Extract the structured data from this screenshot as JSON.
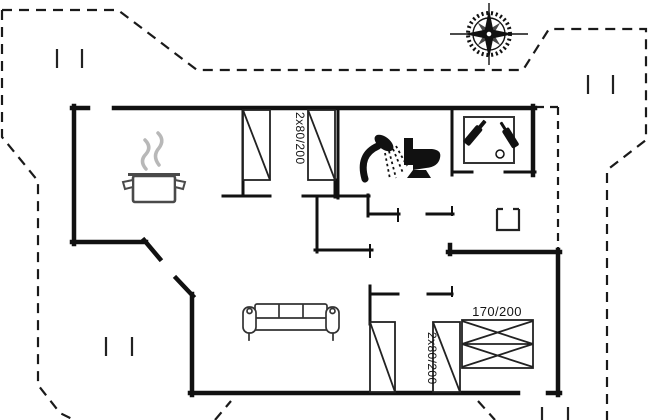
{
  "drawing": {
    "kind": "holiday-house floor plan",
    "labels": {
      "bedroom_top_beds": "2x80/200",
      "bedroom_bottom_beds": "2x80/200",
      "double_bed": "170/200"
    },
    "icons": {
      "compass": "compass-rose",
      "kitchen": "cooking-pot-with-steam",
      "bathroom_shower": "shower",
      "bathroom_toilet": "toilet",
      "utility_room": "bottles-in-box",
      "living_room_sofa": "three-seat-sofa",
      "stove": "wood-stove-square"
    },
    "colors": {
      "wall": "#111111",
      "boundary": "#1a1a1a",
      "furniture": "#222222",
      "steam": "#b8b8b8",
      "background": "#ffffff"
    }
  }
}
